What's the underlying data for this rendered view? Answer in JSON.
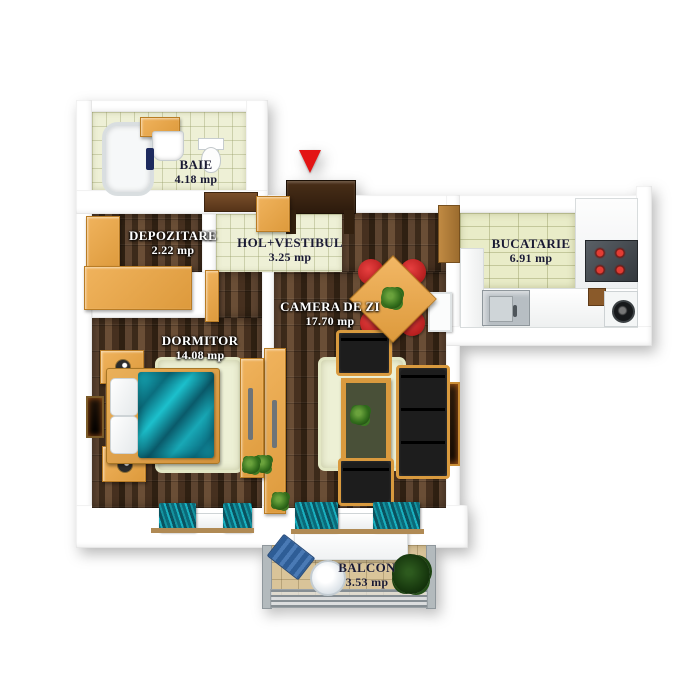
{
  "title": "2-room apartment 3D floor plan",
  "rooms": [
    {
      "name": "baie",
      "label": "BAIE",
      "area": "4.18 mp"
    },
    {
      "name": "depozitare",
      "label": "DEPOZITARE",
      "area": "2.22 mp"
    },
    {
      "name": "hol",
      "label": "HOL+VESTIBUL",
      "area": "3.25 mp"
    },
    {
      "name": "bucatarie",
      "label": "BUCATARIE",
      "area": "6.91 mp"
    },
    {
      "name": "camera_de_zi",
      "label": "CAMERA DE ZI",
      "area": "17.70 mp"
    },
    {
      "name": "dormitor",
      "label": "DORMITOR",
      "area": "14.08 mp"
    },
    {
      "name": "balcon",
      "label": "BALCON",
      "area": "3.53 mp"
    }
  ],
  "entrance_marker": {
    "icon": "red-arrow-down",
    "color": "#e31414"
  },
  "colors": {
    "wall": "#ffffff",
    "tile_floor": "#eef0d6",
    "wood_floor": "#4a3423",
    "balcony_floor": "#d9c499",
    "furniture_orange": "#e2a24b",
    "label_dark": "#1a1a33",
    "label_light": "#ffffff",
    "blanket_teal": "#1298a8",
    "chair_red": "#cc1f1f",
    "sofa_black": "#141414"
  }
}
